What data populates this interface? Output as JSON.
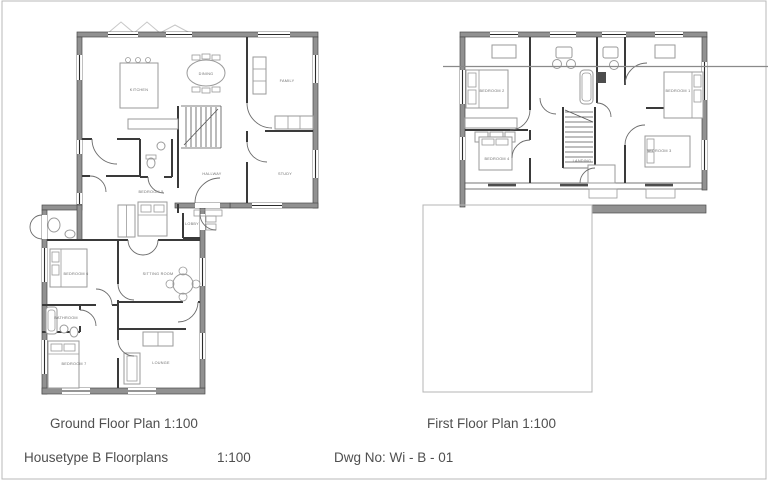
{
  "captions": {
    "ground_floor_title": "Ground Floor Plan 1:100",
    "first_floor_title": "First Floor Plan 1:100",
    "sheet_title": "Housetype B Floorplans",
    "sheet_scale": "1:100",
    "drawing_number": "Dwg No: Wi - B - 01"
  },
  "ground_floor": {
    "labels": {
      "kitchen": "Kitchen",
      "dining": "Dining",
      "family": "Family",
      "hallway": "Hallway",
      "study": "Study",
      "bedroom5": "Bedroom 5",
      "lobby": "Lobby",
      "bedroom6": "Bedroom 6",
      "sitting_room": "Sitting Room",
      "bathroom": "Bathroom",
      "bedroom7": "Bedroom 7",
      "lounge": "Lounge"
    }
  },
  "first_floor": {
    "labels": {
      "bedroom1": "Bedroom 1",
      "bedroom2": "Bedroom 2",
      "bedroom3": "Bedroom 3",
      "bedroom4": "Bedroom 4",
      "landing": "Landing"
    }
  },
  "colors": {
    "wall": "#919191",
    "partition": "#3a3a3a",
    "furniture_line": "#9a9a9a",
    "room_label": "#6e6e6e",
    "caption_text": "#4f4f4f",
    "faint_outline": "#b4b4b4"
  }
}
